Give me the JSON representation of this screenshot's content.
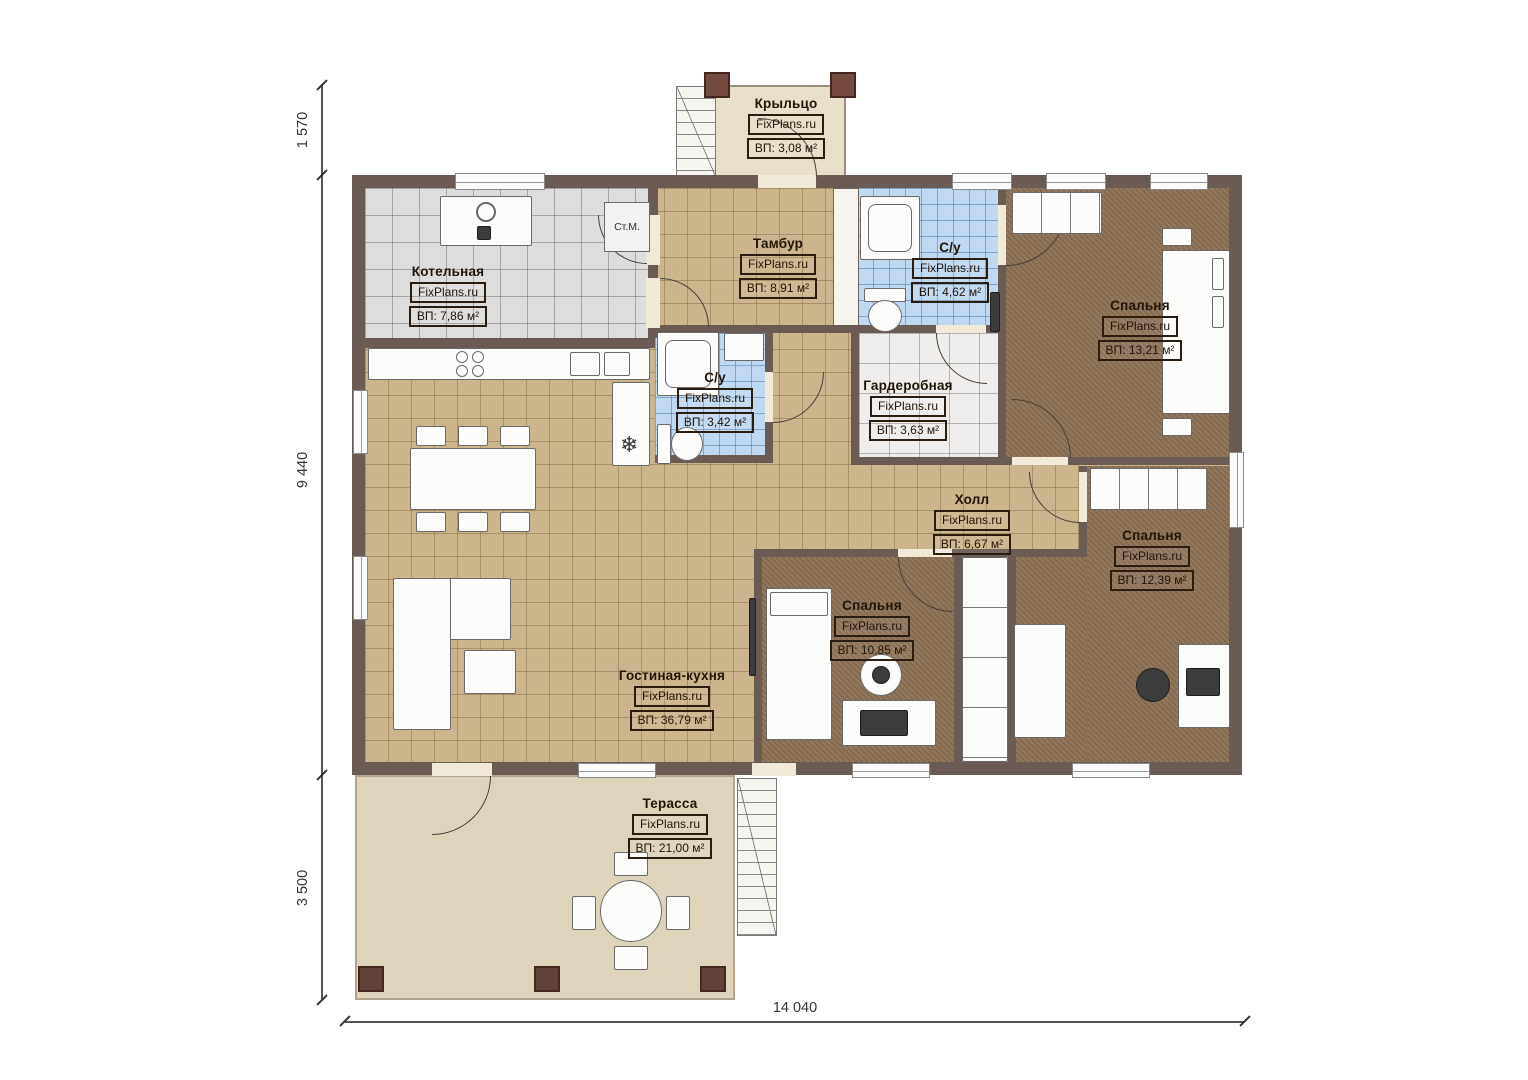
{
  "plan": {
    "watermark": "FixPlans.ru",
    "stm_label": "Ст.М.",
    "fridge_symbol": "❄",
    "rooms": [
      {
        "name": "Крыльцо",
        "area": "ВП: 3,08 м²"
      },
      {
        "name": "Котельная",
        "area": "ВП: 7,86 м²"
      },
      {
        "name": "Тамбур",
        "area": "ВП: 8,91 м²"
      },
      {
        "name": "С/у",
        "area": "ВП: 4,62 м²"
      },
      {
        "name": "Спальня",
        "area": "ВП: 13,21 м²"
      },
      {
        "name": "С/у",
        "area": "ВП: 3,42 м²"
      },
      {
        "name": "Гардеробная",
        "area": "ВП: 3,63 м²"
      },
      {
        "name": "Холл",
        "area": "ВП: 6,67 м²"
      },
      {
        "name": "Спальня",
        "area": "ВП: 12,39 м²"
      },
      {
        "name": "Спальня",
        "area": "ВП: 10,85 м²"
      },
      {
        "name": "Гостиная-кухня",
        "area": "ВП: 36,79 м²"
      },
      {
        "name": "Терасса",
        "area": "ВП: 21,00 м²"
      }
    ],
    "dimensions": {
      "porch_depth": "1 570",
      "house_depth": "9 440",
      "terrace_depth": "3 500",
      "total_width": "14 040"
    },
    "colors": {
      "wall": "#6b5b55",
      "tile_beige": "#cbb58c",
      "tile_gray": "#dddddd",
      "tile_blue": "#c0d8f0",
      "tile_white": "#efeeec",
      "floor_brown": "#8b7156",
      "porch_floor": "#e7dfc9",
      "terrace_floor": "#ded4bb",
      "post": "#754b40",
      "label_ink": "#211507"
    }
  }
}
